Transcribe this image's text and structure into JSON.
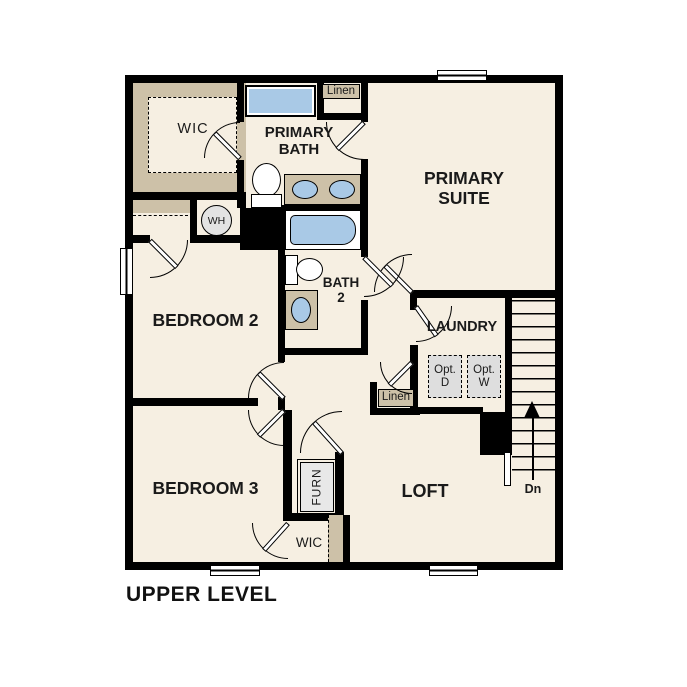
{
  "title": "UPPER LEVEL",
  "rooms": {
    "wic_top": "WIC",
    "primary_bath": {
      "line1": "PRIMARY",
      "line2": "BATH"
    },
    "linen_top": "Linen",
    "primary_suite": {
      "line1": "PRIMARY",
      "line2": "SUITE"
    },
    "bedroom2": "BEDROOM 2",
    "bath2": {
      "line1": "BATH",
      "line2": "2"
    },
    "laundry": "LAUNDRY",
    "linen_hall": "Linen",
    "bedroom3": "BEDROOM 3",
    "loft": "LOFT",
    "wic_bottom": "WIC"
  },
  "fixtures": {
    "water_heater": "WH",
    "furnace": "FURN",
    "opt_dryer": {
      "line1": "Opt.",
      "line2": "D"
    },
    "opt_washer": {
      "line1": "Opt.",
      "line2": "W"
    }
  },
  "stairs": {
    "direction_label": "Dn"
  },
  "colors": {
    "floor": "#f6efe2",
    "closet_tan": "#cdc1a8",
    "fixture_blue": "#a9c9e6",
    "wall_black": "#000000",
    "appliance_gray": "#dedede"
  }
}
